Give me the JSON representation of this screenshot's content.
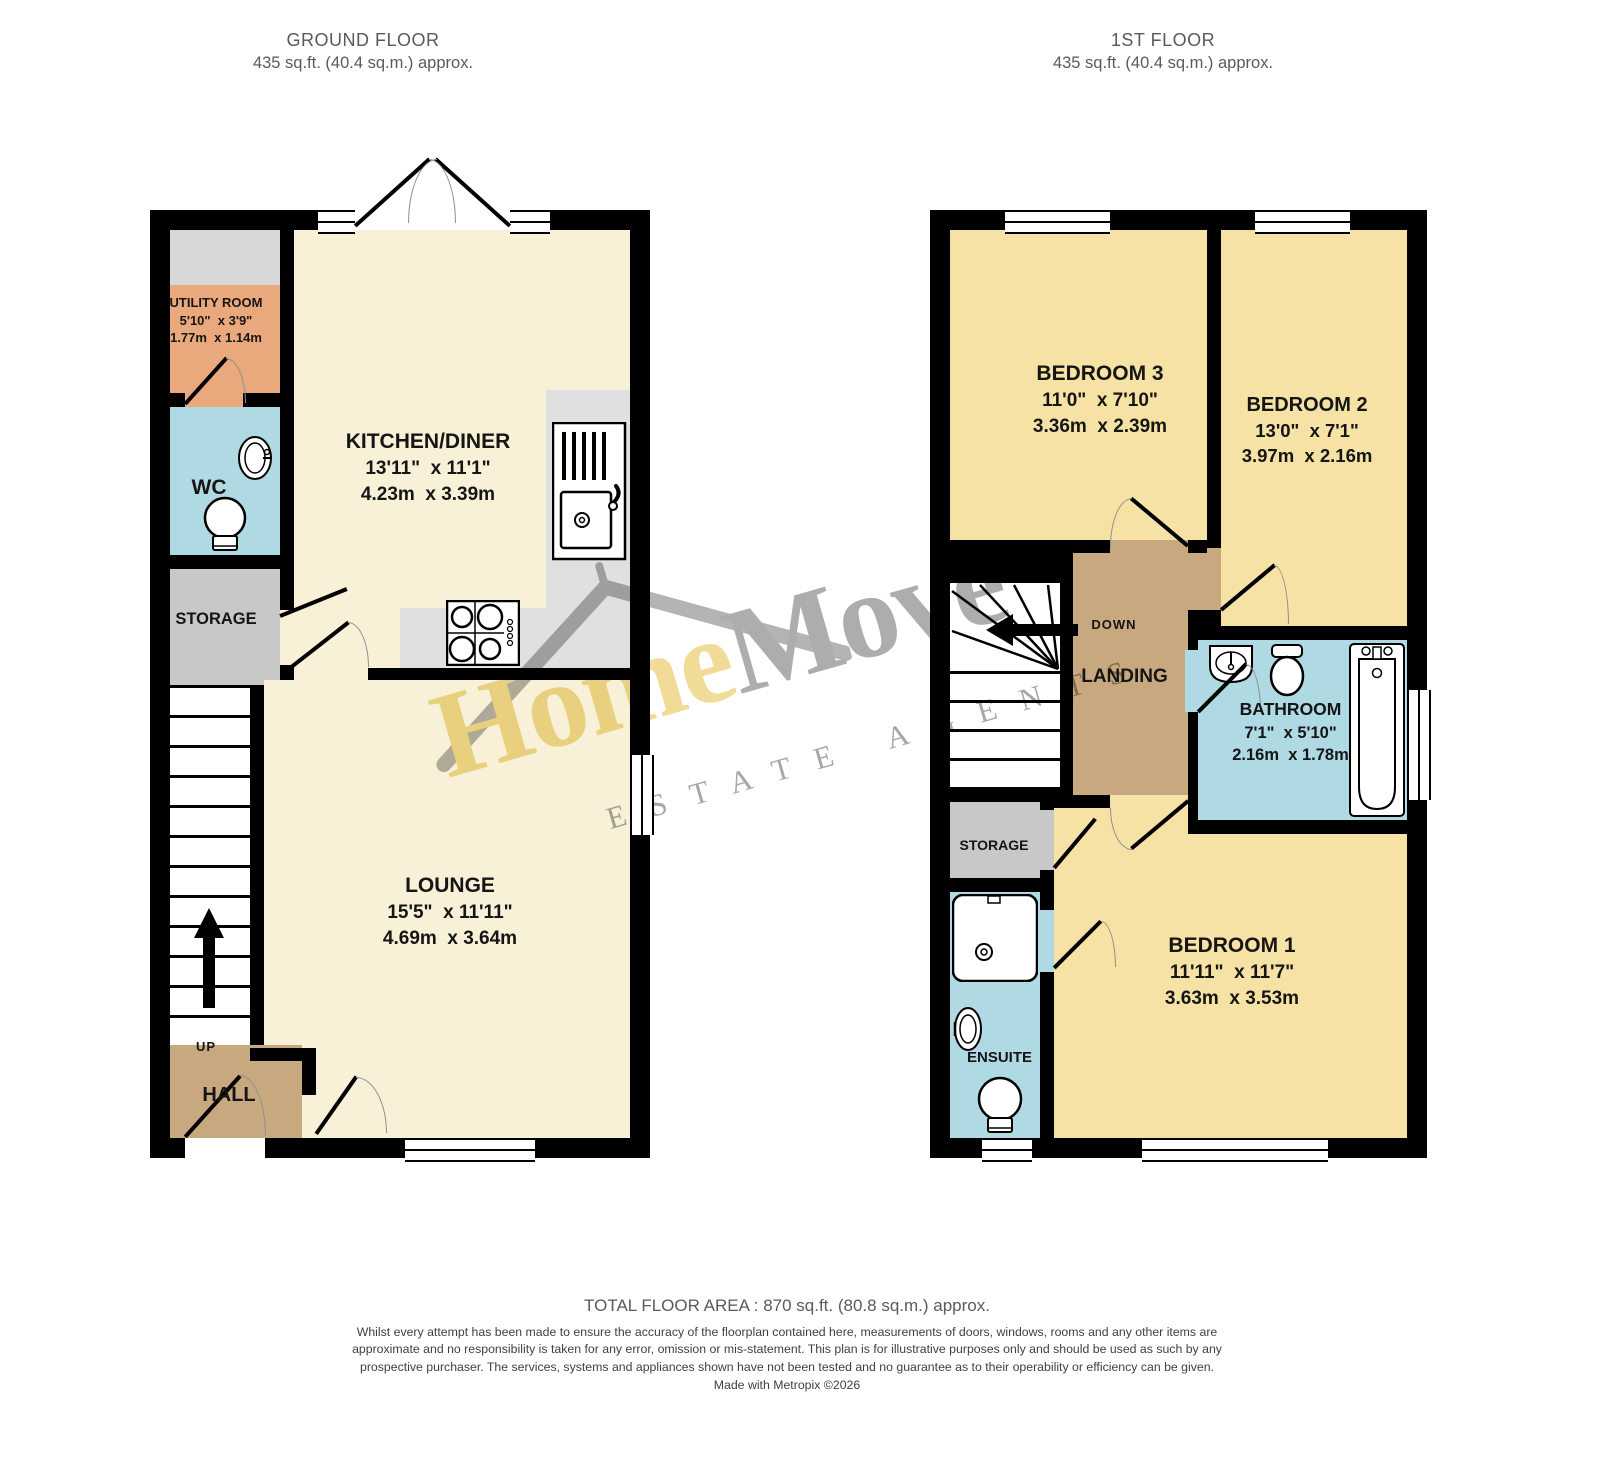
{
  "ground_floor": {
    "title": "GROUND FLOOR",
    "area": "435 sq.ft. (40.4 sq.m.) approx.",
    "utility": {
      "name": "UTILITY ROOM",
      "imperial": "5'10\"  x 3'9\"",
      "metric": "1.77m  x 1.14m"
    },
    "wc": {
      "name": "WC"
    },
    "storage": {
      "name": "STORAGE"
    },
    "kitchen": {
      "name": "KITCHEN/DINER",
      "imperial": "13'11\"  x 11'1\"",
      "metric": "4.23m  x 3.39m"
    },
    "lounge": {
      "name": "LOUNGE",
      "imperial": "15'5\"  x 11'11\"",
      "metric": "4.69m  x 3.64m"
    },
    "hall": {
      "name": "HALL"
    },
    "up_label": "UP"
  },
  "first_floor": {
    "title": "1ST FLOOR",
    "area": "435 sq.ft. (40.4 sq.m.) approx.",
    "bedroom3": {
      "name": "BEDROOM 3",
      "imperial": "11'0\"  x 7'10\"",
      "metric": "3.36m  x 2.39m"
    },
    "bedroom2": {
      "name": "BEDROOM 2",
      "imperial": "13'0\"  x 7'1\"",
      "metric": "3.97m  x 2.16m"
    },
    "landing": {
      "name": "LANDING"
    },
    "down_label": "DOWN",
    "bathroom": {
      "name": "BATHROOM",
      "imperial": "7'1\"  x 5'10\"",
      "metric": "2.16m  x 1.78m"
    },
    "storage": {
      "name": "STORAGE"
    },
    "ensuite": {
      "name": "ENSUITE"
    },
    "bedroom1": {
      "name": "BEDROOM 1",
      "imperial": "11'11\"  x 11'7\"",
      "metric": "3.63m  x 3.53m"
    }
  },
  "watermark": {
    "brand_a": "Home",
    "brand_b": "Move",
    "tagline": "ESTATE AGENTS"
  },
  "footer": {
    "total": "TOTAL FLOOR AREA : 870 sq.ft. (80.8 sq.m.) approx.",
    "disclaimer": "Whilst every attempt has been made to ensure the accuracy of the floorplan contained here, measurements of doors, windows, rooms and any other items are approximate and no responsibility is taken for any error, omission or mis-statement. This plan is for illustrative purposes only and should be used as such by any prospective purchaser. The services, systems and appliances shown have not been tested and no guarantee as to their operability or efficiency can be given.",
    "credit": "Made with Metropix ©2026"
  },
  "colors": {
    "wall": "#000000",
    "cream_room": "#f8f1d8",
    "bedroom_yellow": "#f6e2a4",
    "wet_room_blue": "#afd9e3",
    "utility_orange": "#e9a97d",
    "storage_grey": "#c8c8c8",
    "hall_tan": "#c8a87e",
    "counter_grey": "#e0e0e0",
    "watermark_yellow": "#efd98b",
    "watermark_grey": "#a4a4a4"
  }
}
